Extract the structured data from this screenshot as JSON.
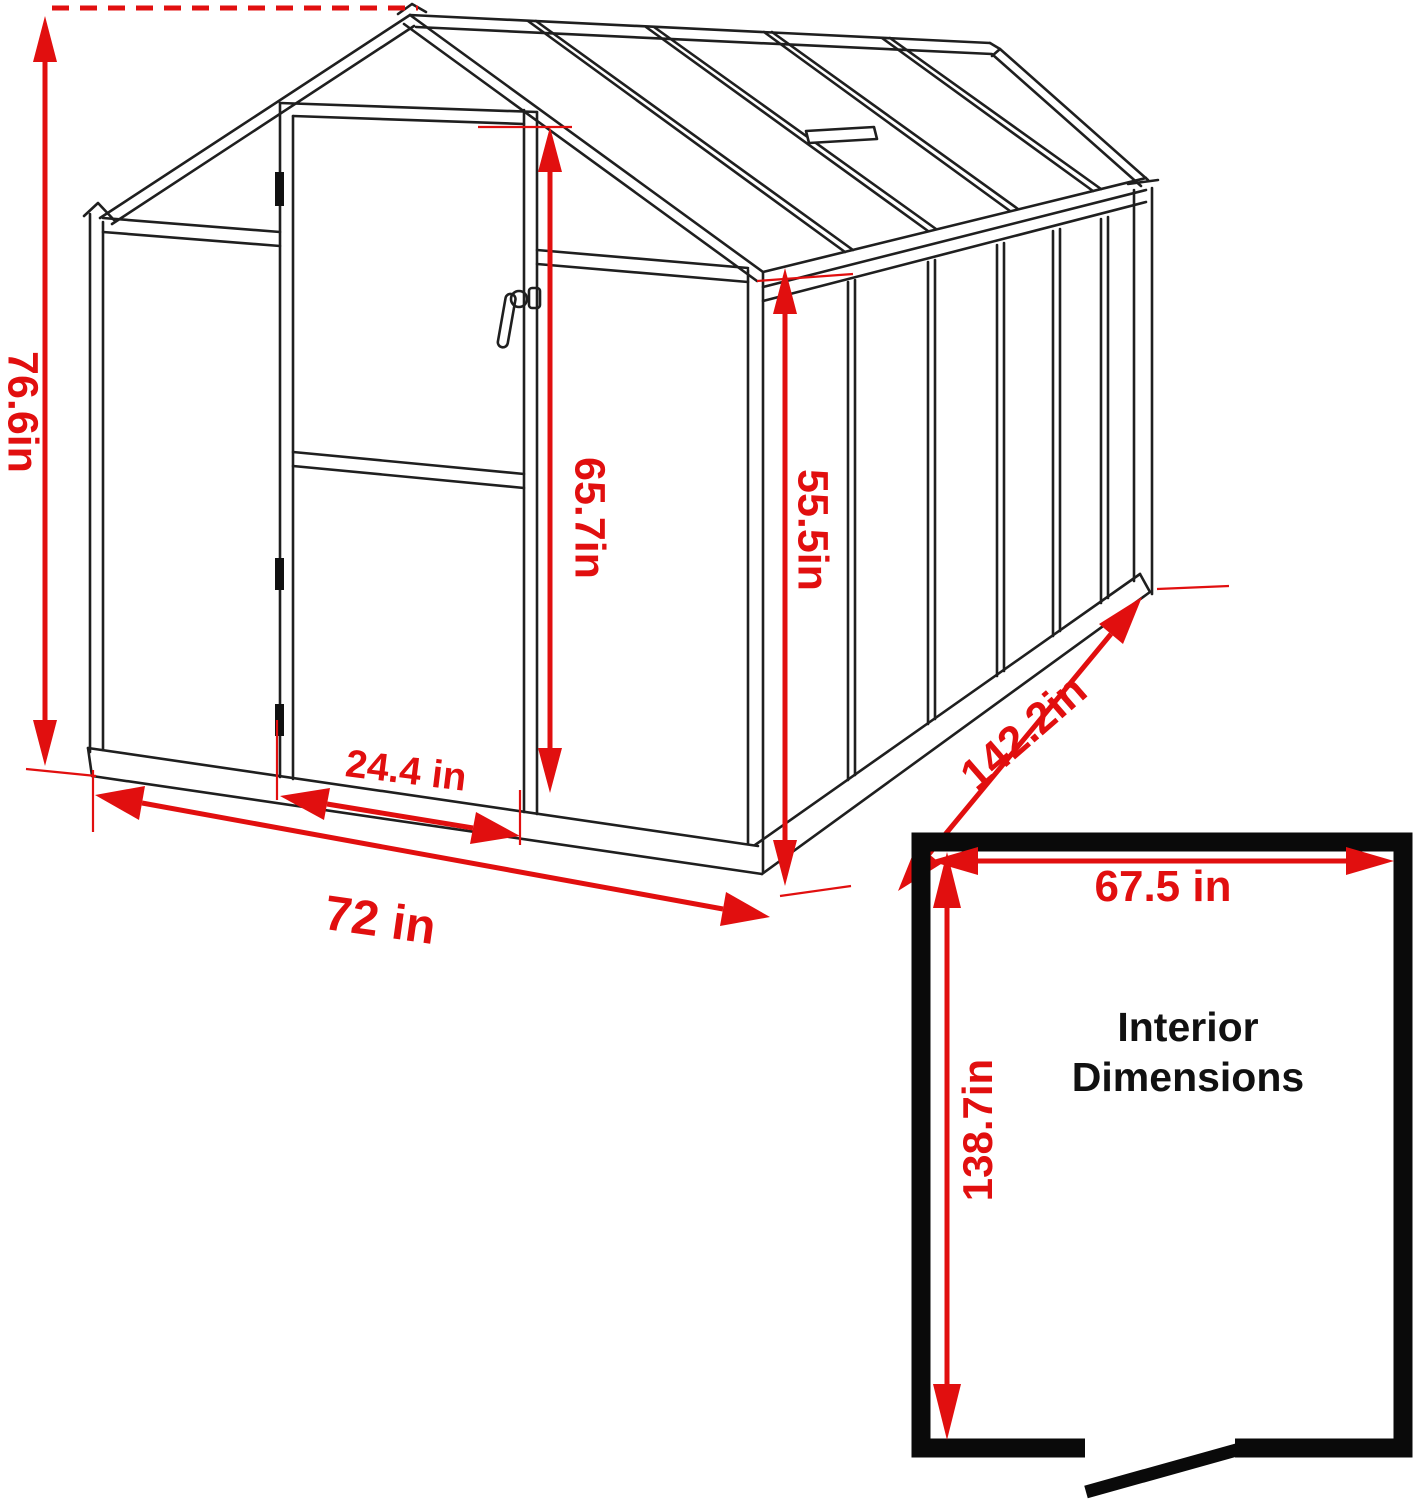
{
  "diagram_type": "greenhouse-dimension-drawing",
  "units": "inches",
  "labels": {
    "overall_height": "76.6in",
    "door_height": "65.7in",
    "wall_height": "55.5in",
    "door_width": "24.4 in",
    "front_width": "72 in",
    "side_length": "142.2in",
    "interior_width": "67.5 in",
    "interior_length": "138.7in",
    "interior_title_line1": "Interior",
    "interior_title_line2": "Dimensions"
  },
  "values": {
    "overall_height_in": 76.6,
    "door_height_in": 65.7,
    "wall_height_in": 55.5,
    "door_width_in": 24.4,
    "front_width_in": 72,
    "side_length_in": 142.2,
    "interior_width_in": 67.5,
    "interior_length_in": 138.7
  },
  "colors": {
    "red": "#e10f0f",
    "line": "#1f1f1f",
    "plan": "#0a0a0a",
    "bg": "#ffffff"
  }
}
